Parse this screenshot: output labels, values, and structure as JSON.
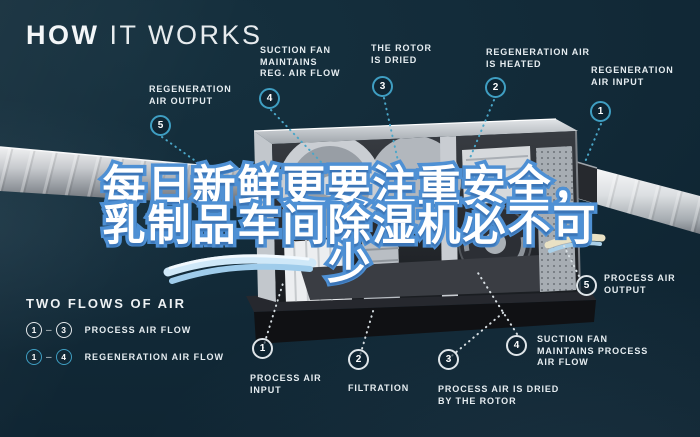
{
  "title": {
    "bold": "HOW",
    "light": " IT WORKS"
  },
  "overlay": {
    "line1": "每日新鲜更要注重安全，",
    "line2": "乳制品车间除湿机必不可",
    "line3": "少"
  },
  "callouts": {
    "reg_output": {
      "num": "5",
      "label": "REGENERATION\nAIR OUTPUT"
    },
    "reg_suction": {
      "num": "4",
      "label": "SUCTION FAN\nMAINTAINS\nREG. AIR FLOW"
    },
    "rotor_dried": {
      "num": "3",
      "label": "THE ROTOR\nIS DRIED"
    },
    "reg_heated": {
      "num": "2",
      "label": "REGENERATION AIR\nIS HEATED"
    },
    "reg_input": {
      "num": "1",
      "label": "REGENERATION\nAIR INPUT"
    },
    "proc_input": {
      "num": "1",
      "label": "PROCESS AIR\nINPUT"
    },
    "filtration": {
      "num": "2",
      "label": "FILTRATION"
    },
    "proc_dried": {
      "num": "3",
      "label": "PROCESS AIR IS DRIED\nBY THE ROTOR"
    },
    "proc_suction": {
      "num": "4",
      "label": "SUCTION FAN\nMAINTAINS PROCESS\nAIR FLOW"
    },
    "proc_output": {
      "num": "5",
      "label": "PROCESS AIR\nOUTPUT"
    }
  },
  "legend": {
    "title": "TWO FLOWS OF AIR",
    "process": {
      "from": "1",
      "to": "3",
      "dash": "–",
      "label": "PROCESS AIR FLOW"
    },
    "regeneration": {
      "from": "1",
      "to": "4",
      "dash": "–",
      "label": "REGENERATION AIR FLOW"
    }
  },
  "colors": {
    "background": "#122a38",
    "accent_cyan": "#3f9ec2",
    "label_text": "#e6edf1",
    "overlay_fill": "#ffffff",
    "overlay_outline": "#4e90d4"
  }
}
